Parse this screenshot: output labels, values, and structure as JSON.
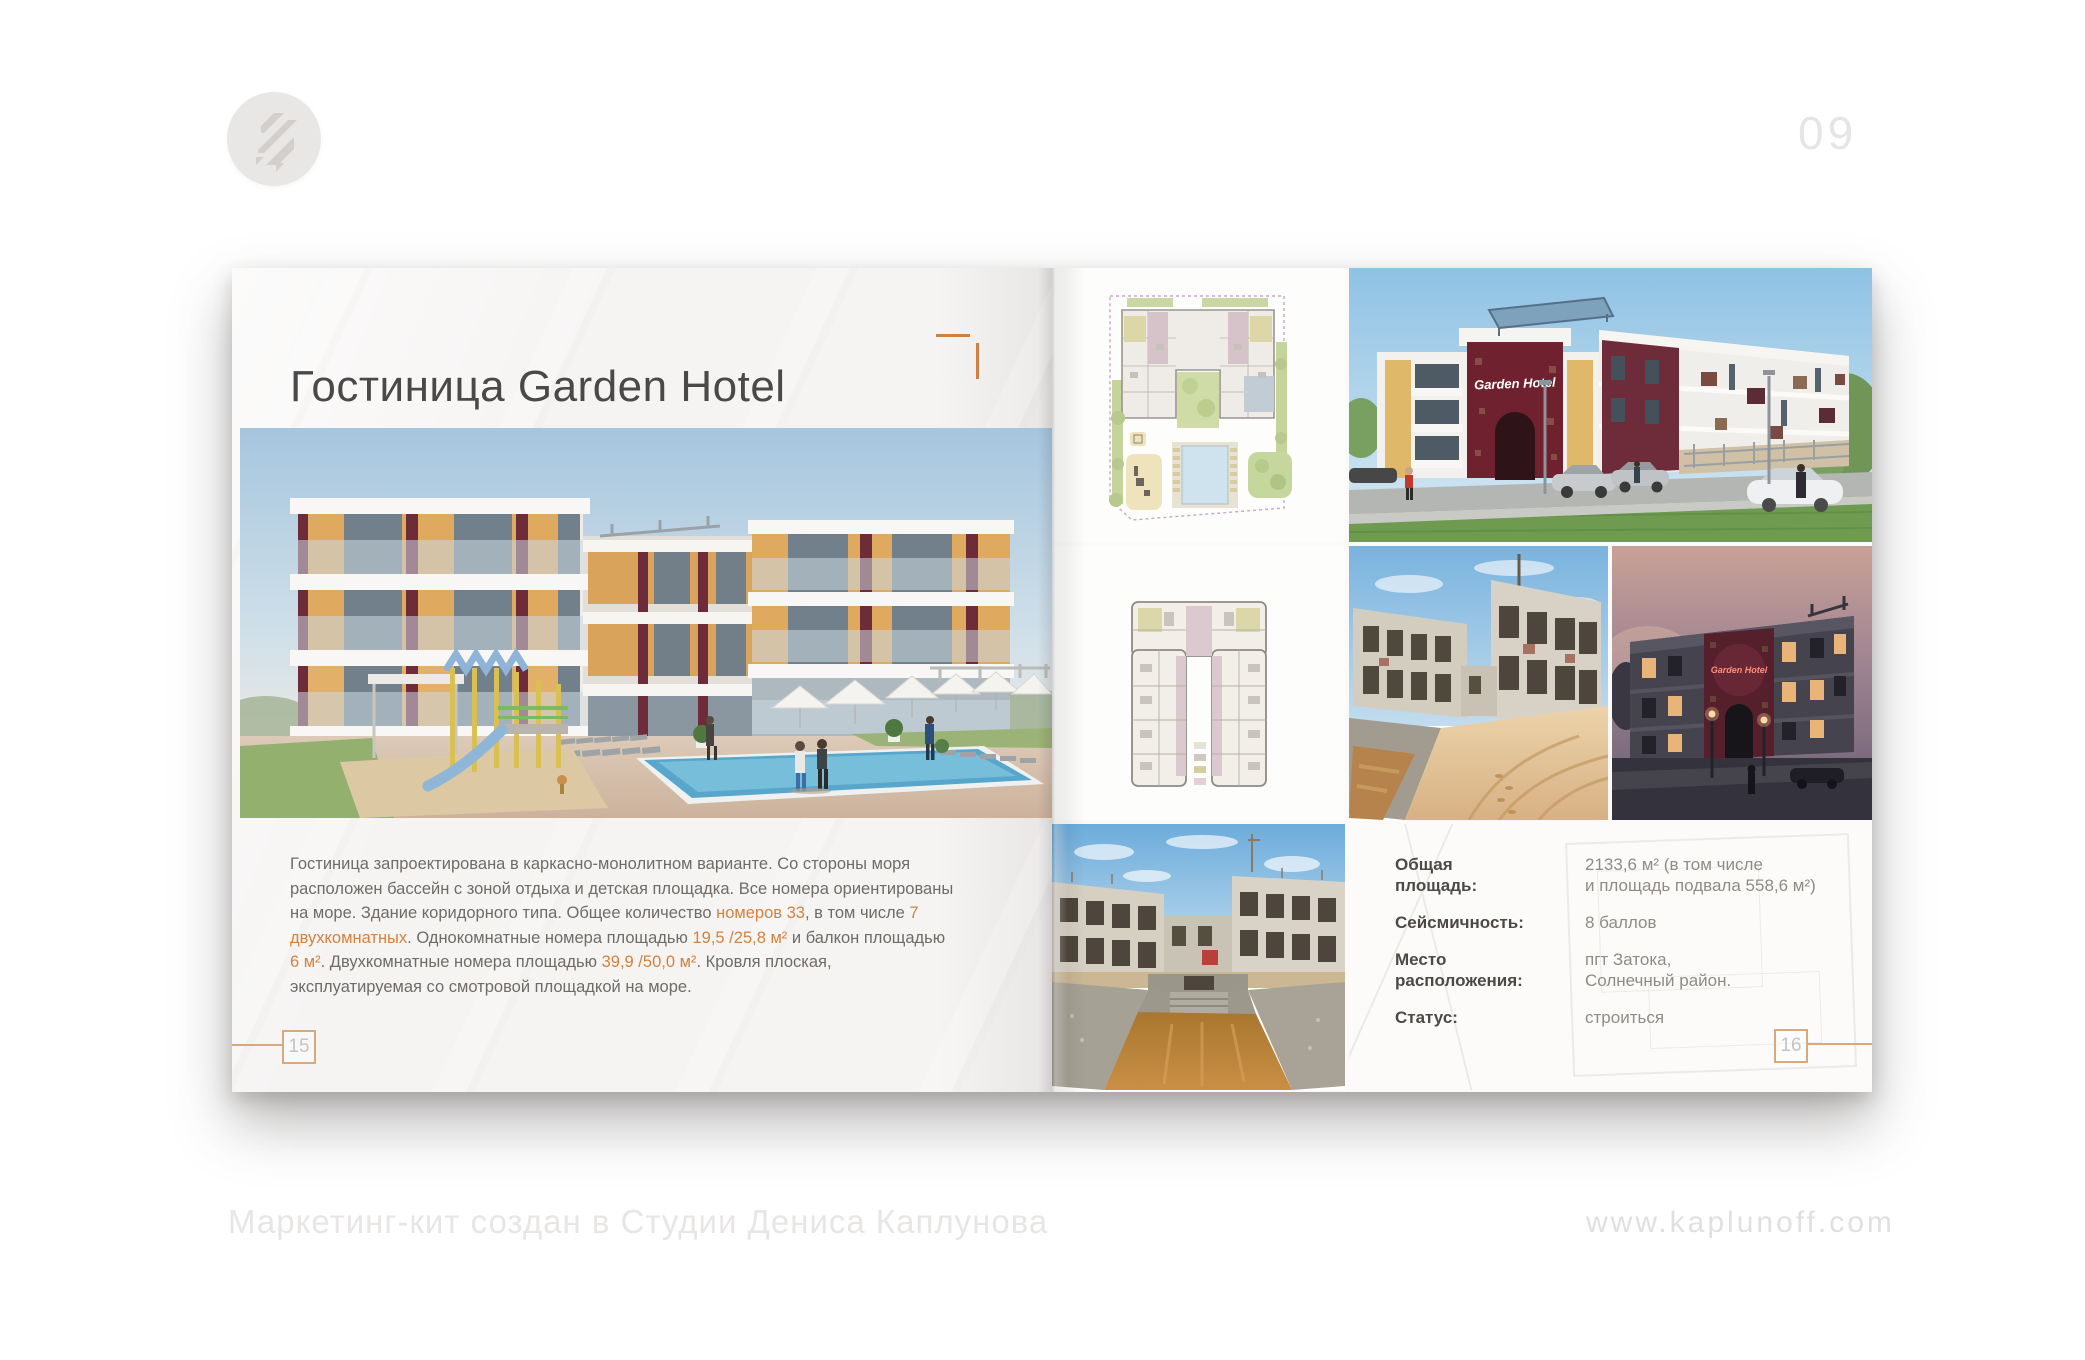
{
  "page_badge": "09",
  "brand": {
    "logo_icon": "kaplunoff-z-lightning"
  },
  "colors": {
    "accent_orange": "#d3813e",
    "frame_tan": "#d8a97c",
    "maroon": "#6e2b39"
  },
  "left_page": {
    "title": "Гостиница Garden Hotel",
    "page_number": "15",
    "paragraph": [
      {
        "text": "Гостиница запроектирована в каркасно-монолитном варианте. Со стороны моря расположен бассейн с зоной отдыха и детская площадка. Все номера ориентированы на море. Здание коридорного типа. Общее количество ",
        "accent": false
      },
      {
        "text": "номеров 33",
        "accent": true
      },
      {
        "text": ", в том числе ",
        "accent": false
      },
      {
        "text": "7 двухкомнатных",
        "accent": true
      },
      {
        "text": ". Однокомнатные номера площадью ",
        "accent": false
      },
      {
        "text": "19,5 /25,8 м²",
        "accent": true
      },
      {
        "text": " и балкон площадью ",
        "accent": false
      },
      {
        "text": "6 м²",
        "accent": true
      },
      {
        "text": ". Двухкомнатные номера площадью ",
        "accent": false
      },
      {
        "text": "39,9 /50,0 м²",
        "accent": true
      },
      {
        "text": ". Кровля плоская, эксплуатируемая со смотровой площадкой на море.",
        "accent": false
      }
    ]
  },
  "right_page": {
    "page_number": "16",
    "gallery": {
      "day_sign": "Garden Hotel",
      "dusk_sign": "Garden Hotel"
    },
    "info": {
      "rows": [
        {
          "label": "Общая\nплощадь:",
          "value": "2133,6 м²  (в том числе\nи площадь подвала 558,6 м²)"
        },
        {
          "label": "Сейсмичность:",
          "value": "8 баллов"
        },
        {
          "label": "Место\nрасположения:",
          "value": "пгт Затока,\nСолнечный район."
        },
        {
          "label": "Статус:",
          "value": "строиться"
        }
      ]
    }
  },
  "footer": {
    "credit": "Маркетинг-кит создан в Студии Дениса Каплунова",
    "site": "www.kaplunoff.com"
  }
}
